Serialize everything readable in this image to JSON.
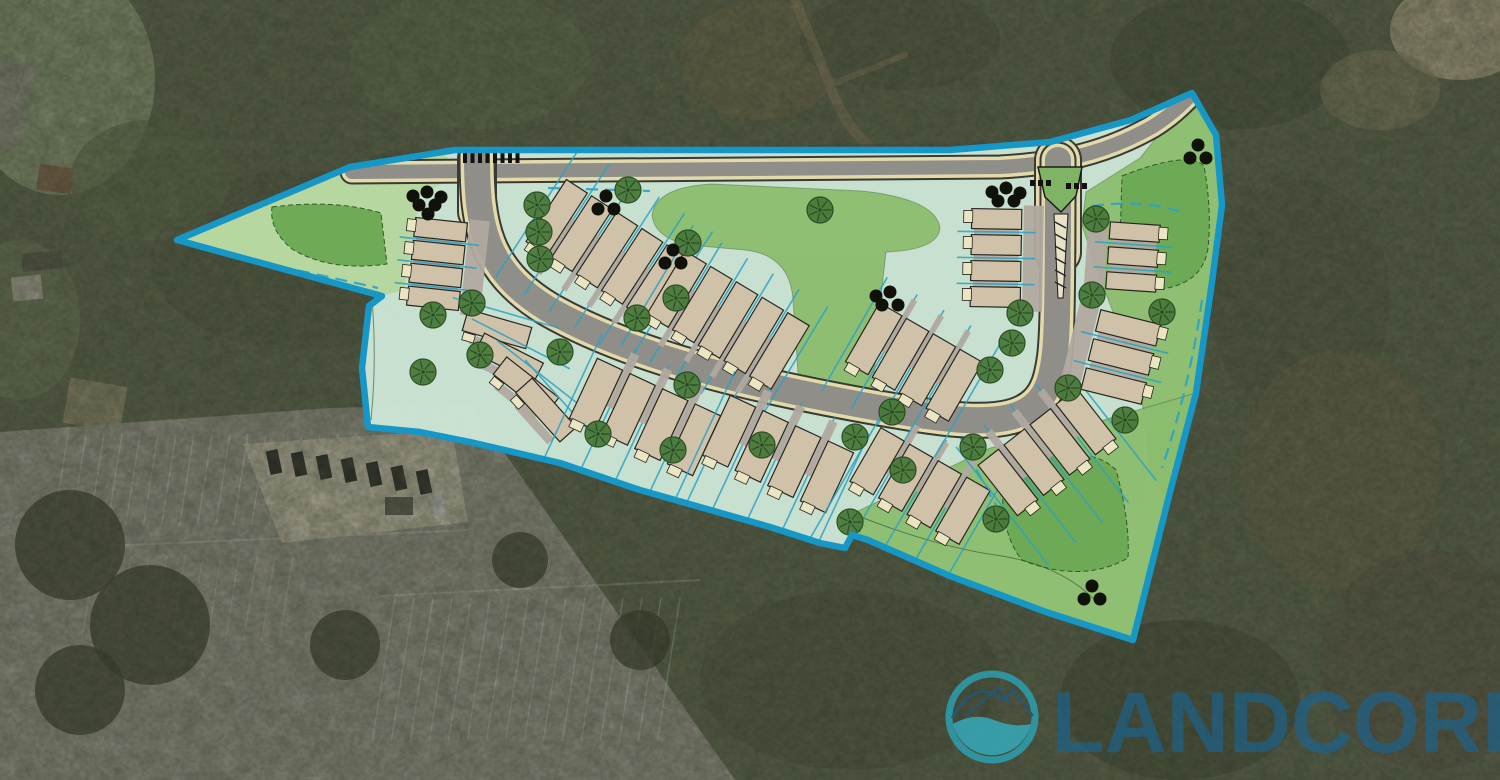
{
  "logo": {
    "text": "LANDCORE",
    "text_color": "#1b6490",
    "mark_teal": "#2ba3b5",
    "mark_wave": "#35aec0",
    "mark_line": "#1d5a80"
  },
  "palette": {
    "mint": "#cfe8d8",
    "wedge": "#b5d69c",
    "lawn": "#8cbd6e",
    "basin": "#6daa55",
    "boundary": "#1697c6",
    "lotline": "#2ba2c4",
    "bar": "#d0c2a9",
    "stoop": "#ece5c3",
    "drive": "#b1a99f",
    "road_gray": "#908e88",
    "road_tan": "#e3daab",
    "road_edge": "#3a3a35",
    "tree_fill": "#49793a",
    "tree_stroke": "#23471c",
    "evergreen": "#101209",
    "median_green": "#7fb465",
    "contour": "#2f4c26"
  },
  "aerial": {
    "base": "#55604a",
    "blobs": [
      {
        "x": 60,
        "y": 80,
        "rx": 95,
        "ry": 115,
        "c": "#8c9b79",
        "o": 0.9
      },
      {
        "x": 20,
        "y": 320,
        "rx": 60,
        "ry": 80,
        "c": "#6d7a5c",
        "o": 0.7
      },
      {
        "x": 470,
        "y": 60,
        "rx": 120,
        "ry": 70,
        "c": "#5e6b4e",
        "o": 0.8
      },
      {
        "x": 760,
        "y": 60,
        "rx": 80,
        "ry": 60,
        "c": "#77684f",
        "o": 0.55
      },
      {
        "x": 900,
        "y": 40,
        "rx": 100,
        "ry": 50,
        "c": "#4a5440",
        "o": 0.8
      },
      {
        "x": 1230,
        "y": 60,
        "rx": 120,
        "ry": 70,
        "c": "#434d3a",
        "o": 0.85
      },
      {
        "x": 1460,
        "y": 30,
        "rx": 70,
        "ry": 50,
        "c": "#b3a88b",
        "o": 0.95
      },
      {
        "x": 1380,
        "y": 90,
        "rx": 60,
        "ry": 40,
        "c": "#8d8668",
        "o": 0.6
      },
      {
        "x": 1300,
        "y": 300,
        "rx": 90,
        "ry": 120,
        "c": "#4e5743",
        "o": 0.85
      },
      {
        "x": 1340,
        "y": 470,
        "rx": 100,
        "ry": 120,
        "c": "#6b614c",
        "o": 0.6
      },
      {
        "x": 1430,
        "y": 660,
        "rx": 110,
        "ry": 110,
        "c": "#575145",
        "o": 0.7
      },
      {
        "x": 1180,
        "y": 700,
        "rx": 120,
        "ry": 80,
        "c": "#3f4836",
        "o": 0.8
      },
      {
        "x": 850,
        "y": 680,
        "rx": 150,
        "ry": 90,
        "c": "#49523d",
        "o": 0.8
      },
      {
        "x": 300,
        "y": 260,
        "rx": 150,
        "ry": 90,
        "c": "#4c5841",
        "o": 0.8
      },
      {
        "x": 150,
        "y": 180,
        "rx": 80,
        "ry": 60,
        "c": "#5a684c",
        "o": 0.7
      },
      {
        "x": 700,
        "y": 350,
        "rx": 200,
        "ry": 120,
        "c": "#515c45",
        "o": 0.6
      },
      {
        "x": 1090,
        "y": 480,
        "rx": 80,
        "ry": 80,
        "c": "#454f3b",
        "o": 0.8
      },
      {
        "x": 240,
        "y": 700,
        "rx": 140,
        "ry": 60,
        "c": "#5d6850",
        "o": 0.8
      },
      {
        "x": 60,
        "y": 740,
        "rx": 90,
        "ry": 50,
        "c": "#76835f",
        "o": 0.8
      }
    ],
    "structures": [
      {
        "x": 38,
        "y": 166,
        "w": 34,
        "h": 26,
        "rot": 8,
        "c": "#7d5b43",
        "o": 0.95
      },
      {
        "x": 12,
        "y": 276,
        "w": 30,
        "h": 24,
        "rot": -6,
        "c": "#b5b0a6",
        "o": 0.9
      },
      {
        "x": 22,
        "y": 252,
        "w": 40,
        "h": 18,
        "rot": -6,
        "c": "#4b4b42",
        "o": 0.9
      },
      {
        "x": 66,
        "y": 382,
        "w": 58,
        "h": 46,
        "rot": 10,
        "c": "#a09579",
        "o": 0.75
      },
      {
        "x": -8,
        "y": 60,
        "w": 36,
        "h": 90,
        "rot": 12,
        "c": "#8d8d85",
        "o": 0.85
      }
    ],
    "dirt_paths": [
      {
        "d": "M 795,0 L 830,85 Q 845,128 872,148",
        "w": 10,
        "c": "#8a7a5c",
        "o": 0.7
      },
      {
        "d": "M 830,85 L 905,55",
        "w": 6,
        "c": "#8a7a5c",
        "o": 0.6
      },
      {
        "d": "M 390,158 L 1010,149",
        "w": 14,
        "c": "#4e5347",
        "o": 0.8
      },
      {
        "d": "M 392,159 Q 300,177 212,216",
        "w": 9,
        "c": "#4e5347",
        "o": 0.55
      },
      {
        "d": "M 0,712 L 430,700",
        "w": 9,
        "c": "#a6a89e",
        "o": 0.5
      }
    ],
    "parking": {
      "lot_points": "0,432 330,408 470,404 735,780 0,780",
      "lot_color": "#98978f",
      "pad_points": "243,444 452,430 468,522 282,543",
      "pad_color": "#c9c2b1",
      "dumpster": {
        "x": 385,
        "y": 497,
        "w": 28,
        "h": 18,
        "c": "#55564f"
      },
      "cars": [
        {
          "x": 268,
          "y": 450
        },
        {
          "x": 293,
          "y": 452
        },
        {
          "x": 318,
          "y": 455
        },
        {
          "x": 343,
          "y": 458
        },
        {
          "x": 368,
          "y": 462
        },
        {
          "x": 393,
          "y": 466
        },
        {
          "x": 418,
          "y": 470
        }
      ],
      "car_color": "#1c1e20",
      "white_car": {
        "x": 432,
        "y": 494,
        "c": "#cfd2d4"
      },
      "stripe_groups": [
        {
          "x0": 68,
          "y0": 434,
          "dx": 18,
          "n": 21,
          "len": 92,
          "ang": 99,
          "o": 0.3
        },
        {
          "x0": 395,
          "y0": 598,
          "dx": 19,
          "n": 16,
          "len": 145,
          "ang": 99,
          "o": 0.3
        },
        {
          "x0": 95,
          "y0": 556,
          "dx": 18,
          "n": 12,
          "len": 86,
          "ang": 99,
          "o": 0.2
        }
      ],
      "aisle_lines": [
        {
          "d": "M 60,548 L 470,530",
          "o": 0.25
        },
        {
          "d": "M 380,596 L 700,580",
          "o": 0.25
        }
      ],
      "tree_blobs": [
        {
          "x": 70,
          "y": 545,
          "r": 55
        },
        {
          "x": 150,
          "y": 625,
          "r": 60
        },
        {
          "x": 80,
          "y": 690,
          "r": 45
        },
        {
          "x": 345,
          "y": 645,
          "r": 35
        },
        {
          "x": 520,
          "y": 560,
          "r": 28
        },
        {
          "x": 640,
          "y": 640,
          "r": 30
        }
      ],
      "tree_blob_color": "#2c3126"
    }
  },
  "site": {
    "boundary_points": "177,240 350,167 455,150 950,150 1050,142 1131,120 1192,93 1216,135 1222,205 1212,282 1196,393 1168,500 1133,640 1046,612 950,576 868,540 852,535 845,548 820,543 770,527 640,490 560,463 470,442 420,432 368,427 362,368 369,306 382,296",
    "wedge_points": "183,241 350,170 445,155 462,172 420,196 404,290 381,296",
    "lawns": [
      {
        "d": "M 652,215 Q 656,187 712,184 L 862,191 Q 936,199 940,228 Q 938,250 886,252 L 880,305 L 872,398 Q 860,412 842,410 L 800,402 L 793,300 Q 790,255 745,250 L 700,246 Q 655,242 652,215 Z"
      },
      {
        "d": "M 1086,192 L 1140,158 L 1191,95 L 1216,135 L 1222,205 L 1212,282 L 1196,393 L 1168,500 L 1150,470 L 1142,400 L 1120,330 L 1096,268 L 1082,225 Z"
      },
      {
        "d": "M 856,512 L 990,448 L 1090,424 L 1196,393 L 1168,500 L 1133,640 L 1046,612 L 950,576 L 862,546 Z"
      }
    ],
    "basins": [
      {
        "d": "M 272,207 Q 335,199 381,213 L 387,264 Q 330,272 292,249 Q 269,230 272,207 Z"
      },
      {
        "d": "M 1122,176 Q 1188,150 1204,166 Q 1212,210 1208,248 Q 1203,283 1162,289 Q 1128,284 1120,240 Z"
      },
      {
        "d": "M 1004,463 Q 1088,441 1116,470 Q 1130,520 1128,558 Q 1082,584 1022,560 Q 997,530 1004,463 Z"
      }
    ],
    "contours": [
      "M 858,516 Q 940,548 1002,556 Q 1062,566 1096,601",
      "M 1094,232 Q 1117,262 1148,287",
      "M 372,300 Q 377,360 371,420"
    ],
    "teal_dashes": [
      "M 205,252 Q 300,270 378,288",
      "M 420,182 L 462,182",
      "M 548,188 L 650,191",
      "M 1092,206 Q 1145,199 1180,212",
      "M 1202,300 Q 1190,385 1162,468",
      "M 952,418 Q 975,470 996,505"
    ],
    "roads": [
      {
        "name": "frontage-road",
        "d": "M 352,172 L 1000,167 C 1075,163 1118,146 1152,127 C 1170,116 1181,105 1191,95",
        "w": [
          25,
          21,
          14
        ]
      },
      {
        "name": "entry-throat-left",
        "d": "M 477,212 L 477,158",
        "w": [
          40,
          36,
          29
        ]
      },
      {
        "name": "entry-throat-right",
        "d": "M 1058,252 L 1058,160",
        "w": [
          48,
          44,
          37
        ]
      },
      {
        "name": "loop-road",
        "d": "M 477,156 C 477,225 484,270 548,309 C 640,362 780,392 920,415 C 998,427 1040,421 1051,376 C 1057,352 1058,330 1058,160",
        "w": [
          37,
          33,
          26
        ]
      }
    ],
    "median": {
      "teardrop": "1038,167 1082,167 1076,196 1061,212 1045,197",
      "tail": "1054,214 1068,214 1063,298 1058,298",
      "hatch_n": 6
    },
    "crosswalk": {
      "x": 463,
      "y": 152,
      "n": 8,
      "step": 7.5,
      "w": 4,
      "h": 11
    },
    "stop_bars": [
      {
        "x": 1030,
        "y": 180,
        "n": 3,
        "step": 8
      },
      {
        "x": 1066,
        "y": 183,
        "n": 3,
        "step": 8
      }
    ],
    "rows": [
      {
        "name": "A",
        "kind": "stack",
        "cx": 437,
        "cy": 264,
        "angle": 96,
        "n": 4,
        "pitch": 23,
        "barW": 19,
        "barLen": 52,
        "stoopSign": 1,
        "laneSign": -1
      },
      {
        "name": "B",
        "kind": "fan",
        "barW": 22,
        "barLen": 66,
        "bars": [
          [
            497,
            329,
            16
          ],
          [
            509,
            358,
            27
          ],
          [
            526,
            386,
            38
          ],
          [
            546,
            410,
            48
          ]
        ]
      },
      {
        "name": "C",
        "kind": "front",
        "cx": 607,
        "cy": 250,
        "angle": 33,
        "n": 5,
        "pitch": 30,
        "barW": 25,
        "barLen": 74,
        "driveSign": 1,
        "stoopSign": 1,
        "extNeg": 36,
        "extPos": 46
      },
      {
        "name": "D",
        "kind": "front",
        "cx": 728,
        "cy": 320,
        "angle": 31,
        "n": 5,
        "pitch": 30,
        "barW": 25,
        "barLen": 74,
        "driveSign": 1,
        "stoopSign": 1,
        "extNeg": 26,
        "extPos": 40
      },
      {
        "name": "E",
        "kind": "front",
        "cx": 645,
        "cy": 417,
        "angle": 25,
        "n": 4,
        "pitch": 36,
        "barW": 28,
        "barLen": 66,
        "driveSign": -1,
        "stoopSign": 1,
        "extNeg": 24,
        "extPos": 108
      },
      {
        "name": "F",
        "kind": "front",
        "cx": 778,
        "cy": 454,
        "angle": 25,
        "n": 4,
        "pitch": 36,
        "barW": 28,
        "barLen": 66,
        "driveSign": -1,
        "stoopSign": 1,
        "extNeg": 24,
        "extPos": 92
      },
      {
        "name": "G",
        "kind": "front",
        "cx": 920,
        "cy": 486,
        "angle": 30,
        "n": 4,
        "pitch": 33,
        "barW": 27,
        "barLen": 62,
        "driveSign": -1,
        "stoopSign": 1,
        "extNeg": 22,
        "extPos": 82
      },
      {
        "name": "H",
        "kind": "front",
        "cx": 1047,
        "cy": 452,
        "angle": 142,
        "n": 4,
        "pitch": 33,
        "barW": 26,
        "barLen": 64,
        "driveSign": 1,
        "stoopSign": -1,
        "extNeg": 58,
        "extPos": 28
      },
      {
        "name": "I",
        "kind": "stack",
        "cx": 1121,
        "cy": 357,
        "angle": 104,
        "n": 3,
        "pitch": 30,
        "barW": 22,
        "barLen": 62,
        "stoopSign": -1,
        "laneSign": 1
      },
      {
        "name": "J",
        "kind": "stack",
        "cx": 1133,
        "cy": 257,
        "angle": 94,
        "n": 3,
        "pitch": 25,
        "barW": 17,
        "barLen": 50,
        "stoopSign": -1,
        "laneSign": 1
      },
      {
        "name": "K",
        "kind": "stack",
        "cx": 996,
        "cy": 258,
        "angle": 91,
        "n": 4,
        "pitch": 26,
        "barW": 20,
        "barLen": 50,
        "stoopSign": 1,
        "laneSign": -1
      },
      {
        "name": "L",
        "kind": "front",
        "cx": 914,
        "cy": 362,
        "angle": 30,
        "n": 4,
        "pitch": 31,
        "barW": 26,
        "barLen": 68,
        "driveSign": -1,
        "stoopSign": 1,
        "extNeg": 26,
        "extPos": 38
      }
    ],
    "trees": [
      [
        537,
        205
      ],
      [
        539,
        232
      ],
      [
        540,
        259
      ],
      [
        628,
        190
      ],
      [
        820,
        210
      ],
      [
        688,
        243
      ],
      [
        676,
        298
      ],
      [
        433,
        315
      ],
      [
        472,
        303
      ],
      [
        423,
        372
      ],
      [
        480,
        355
      ],
      [
        560,
        352
      ],
      [
        637,
        318
      ],
      [
        687,
        385
      ],
      [
        673,
        450
      ],
      [
        598,
        434
      ],
      [
        762,
        445
      ],
      [
        850,
        522
      ],
      [
        855,
        437
      ],
      [
        892,
        412
      ],
      [
        903,
        470
      ],
      [
        973,
        447
      ],
      [
        1020,
        313
      ],
      [
        1012,
        343
      ],
      [
        990,
        370
      ],
      [
        1068,
        388
      ],
      [
        1162,
        312
      ],
      [
        1125,
        420
      ],
      [
        996,
        519
      ],
      [
        1096,
        219
      ],
      [
        1092,
        295
      ]
    ],
    "evergreen_clusters": [
      {
        "x": 427,
        "y": 200,
        "n": 6
      },
      {
        "x": 606,
        "y": 204,
        "n": 3
      },
      {
        "x": 673,
        "y": 258,
        "n": 3
      },
      {
        "x": 890,
        "y": 300,
        "n": 4
      },
      {
        "x": 1006,
        "y": 196,
        "n": 5
      },
      {
        "x": 1198,
        "y": 153,
        "n": 3
      },
      {
        "x": 1092,
        "y": 594,
        "n": 3
      }
    ]
  }
}
